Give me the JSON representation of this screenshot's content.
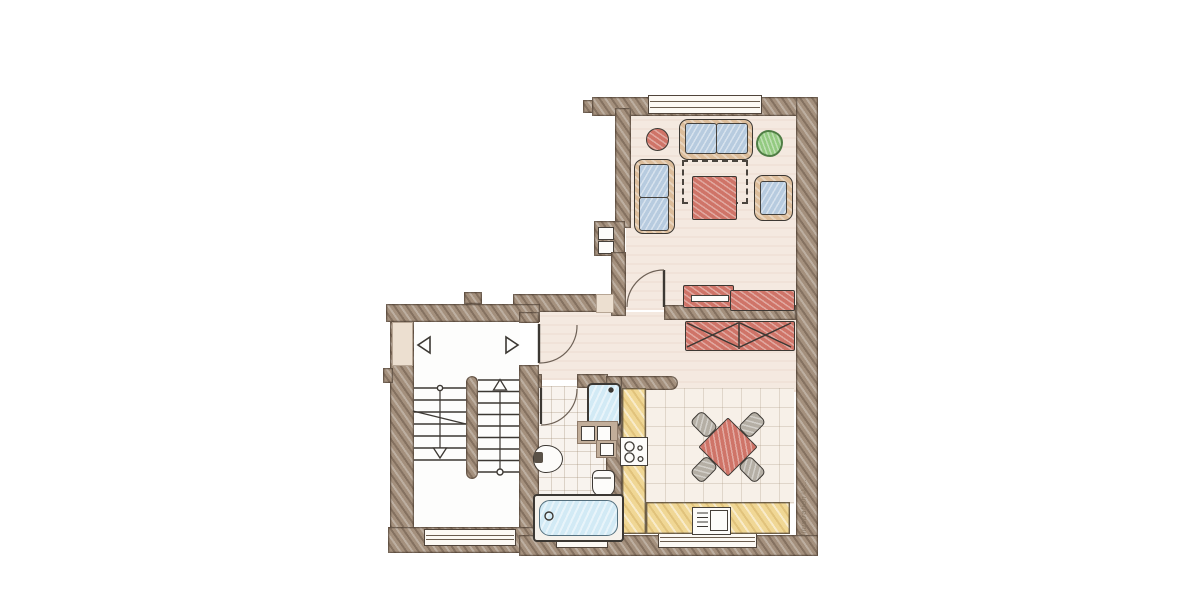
{
  "watermark": "Illustration©…",
  "palette": {
    "wall": "#a4907d",
    "wall_line": "#51453a",
    "floor": "#f4e9e0",
    "tile_bath": "#f8f3ee",
    "tile_kitchen": "#f7f0e8",
    "counter": "#f0d795",
    "red": "#cf7468",
    "blue": "#b7cbdf",
    "tan": "#dcbd9b",
    "green": "#93ca81",
    "aqua": "#d2eaf5",
    "gray": "#b5afa5",
    "line": "#3c3833"
  },
  "plan": {
    "type": "apartment-floor-plan-sketch",
    "rooms": [
      "living-room",
      "hallway",
      "bathroom",
      "kitchen",
      "stairwell"
    ],
    "living_room_items": [
      "round-pouf",
      "two-seat-sofa-top",
      "plant",
      "two-seat-sofa-left",
      "rug-dashed",
      "coffee-table",
      "armchair",
      "sideboard-with-tv",
      "sideboard-low",
      "door-swing"
    ],
    "hallway_items": [
      "wardrobe-x-front",
      "entrance-door-swing"
    ],
    "bathroom_items": [
      "shower",
      "washer-units",
      "toilet",
      "sink",
      "bathtub",
      "door-swing",
      "tiled-floor"
    ],
    "kitchen_items": [
      "l-shaped-counter",
      "cooktop-4-burners",
      "dining-table-diamond",
      "4-chairs",
      "sink-unit",
      "tiled-floor"
    ],
    "stairwell_items": [
      "upper-landing",
      "direction-triangles",
      "double-flight-stairs",
      "up-arrow",
      "down-arrow",
      "lower-landing",
      "window"
    ],
    "windows": [
      "living-room-top",
      "stairwell-bottom",
      "bathroom-bottom",
      "kitchen-bottom"
    ]
  }
}
